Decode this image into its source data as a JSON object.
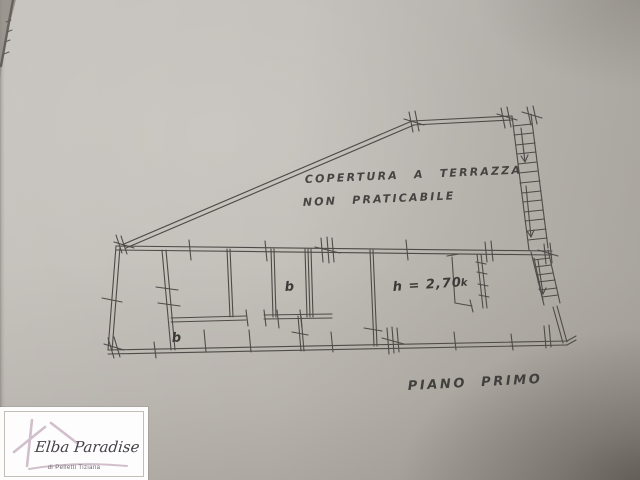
{
  "plan": {
    "terrace_note_line1": "COPERTURA A TERRAZZA",
    "terrace_note_line2": "NON PRATICABILE",
    "floor_title": "PIANO PRIMO",
    "ceiling_height": "h = 2,70",
    "labels": {
      "bath_main": "b",
      "bath_small": "b",
      "kitchen": "k"
    }
  },
  "watermark": {
    "agency": "Elba Paradise",
    "tagline": "di Pelletti Tiziana"
  },
  "colors": {
    "ink": "#4e4b48",
    "paper": "#bfbbb5",
    "logo_accent": "#cdb9c6"
  }
}
